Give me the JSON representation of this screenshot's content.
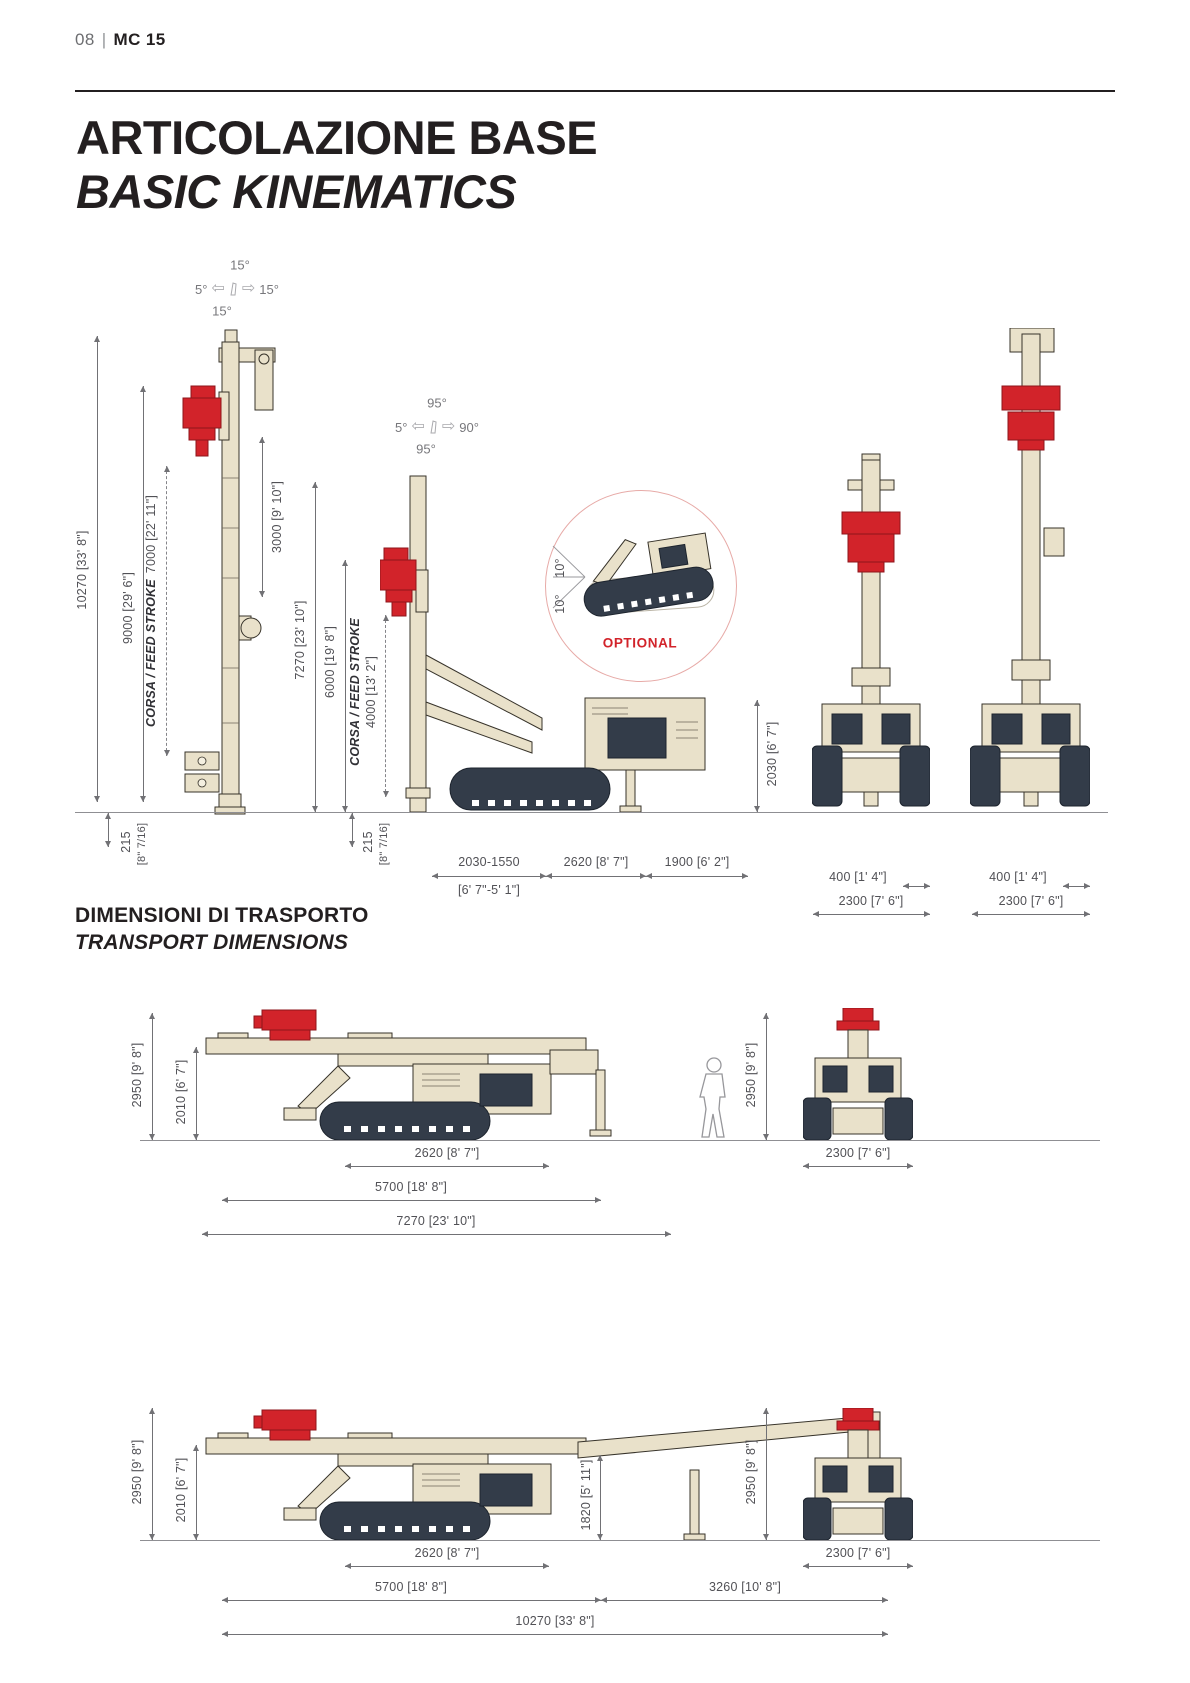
{
  "page": {
    "number": "08",
    "separator": "|",
    "model": "MC 15"
  },
  "icons": {
    "arrow_left": "⇦",
    "arrow_right": "⇨"
  },
  "colors": {
    "accent_red": "#d2232a",
    "machine_beige": "#e8e0c8",
    "track_navy": "#333c49",
    "dim_gray": "#515156",
    "optional_circle_pink": "#e7aaa7"
  },
  "kinematics": {
    "title_it": "ARTICOLAZIONE BASE",
    "title_en": "BASIC KINEMATICS",
    "mast_tilt": {
      "top": "15°",
      "left": "5°",
      "right": "15°",
      "bottom": "15°"
    },
    "mast_swing": {
      "top": "95°",
      "left": "5°",
      "right": "90°",
      "bottom": "95°"
    },
    "dims": {
      "total_height": "10270 [33' 8\"]",
      "working_height": "9000 [29' 6\"]",
      "feed_stroke_label": "CORSA / FEED STROKE",
      "feed_stroke_long": "7000 [22' 11\"]",
      "head_travel": "3000 [9' 10\"]",
      "mid_total_height": "7270 [23' 10\"]",
      "mid_working_height": "6000 [19' 8\"]",
      "feed_stroke_short": "4000 [13' 2\"]",
      "ground_clearance": "215",
      "ground_clearance_sub": "[8\" 7/16]",
      "front_reach": "2030-1550",
      "front_reach_sub": "[6' 7\"-5' 1\"]",
      "track_length": "2620 [8' 7\"]",
      "rear_length": "1900 [6' 2\"]",
      "body_height": "2030 [6' 7\"]",
      "track_width": "400 [1' 4\"]",
      "overall_width": "2300 [7' 6\"]"
    },
    "optional": {
      "label": "OPTIONAL",
      "oscillation_left": "10°",
      "oscillation_right": "10°"
    }
  },
  "transport": {
    "title_it": "DIMENSIONI DI TRASPORTO",
    "title_en": "TRANSPORT DIMENSIONS",
    "config1": {
      "overall_height": "2950 [9' 8\"]",
      "body_height": "2010 [6' 7\"]",
      "track_length": "2620 [8' 7\"]",
      "crawler_length": "5700 [18' 8\"]",
      "total_length": "7270 [23' 10\"]",
      "front_height": "2950 [9' 8\"]",
      "overall_width": "2300 [7' 6\"]"
    },
    "config2": {
      "overall_height": "2950 [9' 8\"]",
      "body_height": "2010 [6' 7\"]",
      "mast_height": "1820 [5' 11\"]",
      "track_length": "2620 [8' 7\"]",
      "crawler_length": "5700 [18' 8\"]",
      "mast_overhang": "3260 [10' 8\"]",
      "total_length": "10270 [33' 8\"]",
      "front_height": "2950 [9' 8\"]",
      "overall_width": "2300 [7' 6\"]"
    }
  }
}
